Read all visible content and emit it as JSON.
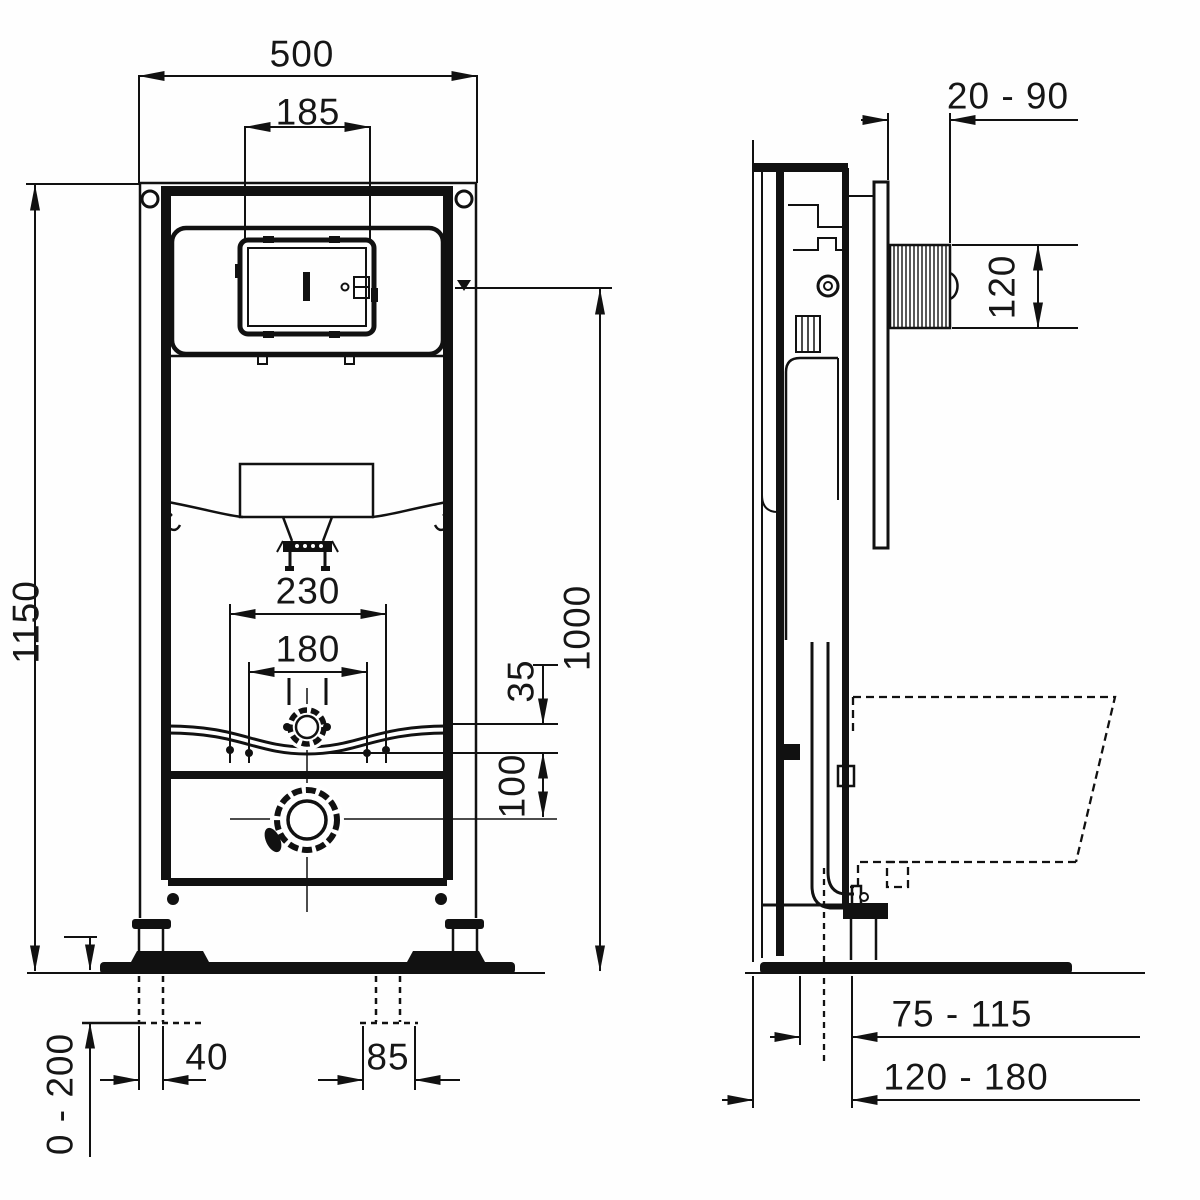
{
  "drawing": {
    "type": "installation frame technical drawing",
    "views": [
      "front",
      "side"
    ]
  },
  "dims": {
    "front": {
      "frame_width": "500",
      "flush_plate_cutout_width": "185",
      "frame_height": "1150",
      "fixing_bolts_outer": "230",
      "fixing_bolts_inner": "180",
      "inlet_offset": "35",
      "outlet_offset": "100",
      "reference_height": "1000",
      "foot_offset_left": "40",
      "foot_offset_right": "85",
      "floor_adjustment": "0 - 200"
    },
    "side": {
      "wall_distance": "20 - 90",
      "shaft_height": "120",
      "drain_distance": "75 - 115",
      "frame_depth": "120 - 180"
    }
  }
}
